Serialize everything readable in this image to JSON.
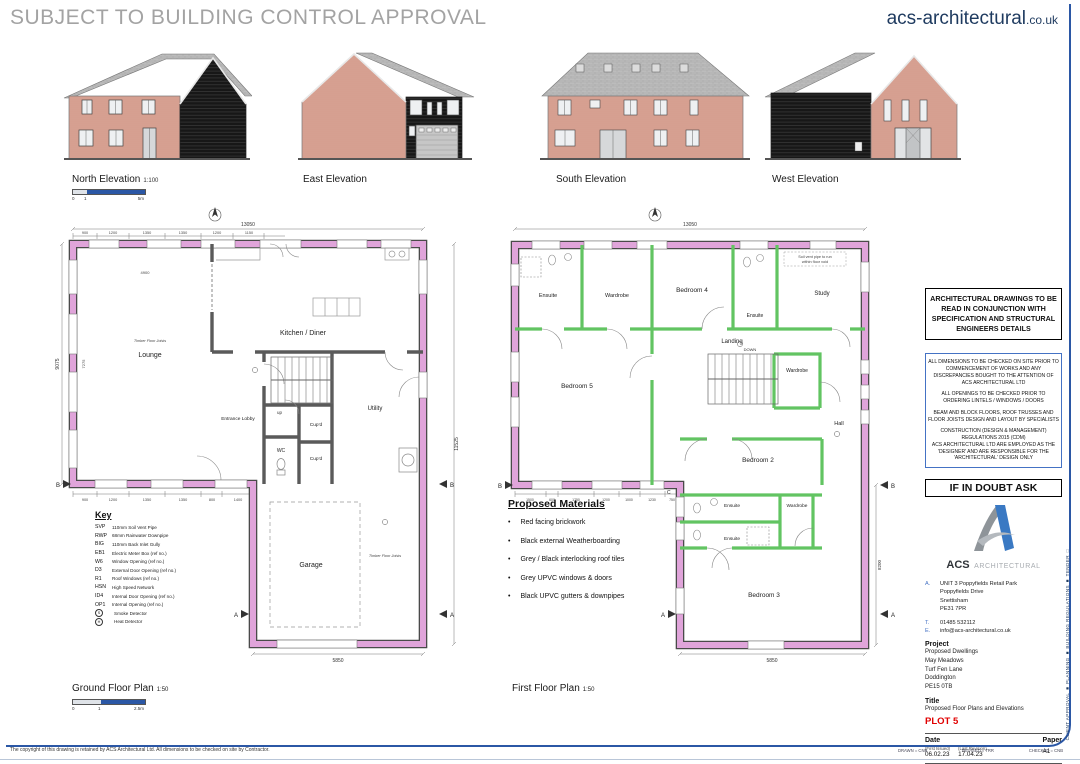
{
  "sheet": {
    "watermark": "SUBJECT TO BUILDING CONTROL APPROVAL",
    "website_name": "acs-architectural",
    "website_tld": ".co.uk"
  },
  "elevations": {
    "north": {
      "label": "North Elevation",
      "scale": "1:100",
      "bar0": "0",
      "bar1": "1",
      "bar2": "5m"
    },
    "east": {
      "label": "East Elevation"
    },
    "south": {
      "label": "South Elevation"
    },
    "west": {
      "label": "West Elevation"
    }
  },
  "ground": {
    "label": "Ground Floor Plan",
    "scale": "1:50",
    "bar0": "0",
    "bar1": "1",
    "bar2": "2.5m",
    "rooms": {
      "lounge": "Lounge",
      "kitchen": "Kitchen / Diner",
      "lobby": "Entrance Lobby",
      "utility": "Utility",
      "wc": "WC",
      "cupd1": "Cup'd",
      "cupd2": "Cup'd",
      "garage": "Garage"
    },
    "stair": "up",
    "timber1": "Timber Floor Joists",
    "timber2": "Timber Floor Joists",
    "dims": {
      "top": "13050",
      "left": "9075",
      "right": "11525",
      "bottom": "5850",
      "inner": "5250",
      "lounge_w": "4900",
      "lounge_h": "7275"
    },
    "top_segs": [
      "900",
      "1200",
      "1350",
      "1350",
      "1200",
      "1150"
    ],
    "bottom_segs": [
      "900",
      "1200",
      "1350",
      "1350",
      "800",
      "1400"
    ]
  },
  "first": {
    "label": "First Floor Plan",
    "scale": "1:50",
    "rooms": {
      "ensuite1": "Ensuite",
      "wardrobe1": "Wardrobe",
      "bed4": "Bedroom 4",
      "ensuite2": "Ensuite",
      "study": "Study",
      "bed5": "Bedroom 5",
      "landing": "Landing",
      "wardrobe2": "Wardrobe",
      "hall": "Hall",
      "bed2": "Bedroom 2",
      "ensuite3": "Ensuite",
      "ensuite4": "Ensuite",
      "wardrobe3": "Wardrobe",
      "bed3": "Bedroom 3"
    },
    "stair": "DOWN",
    "note1": "Soil vent pipe to run",
    "note2": "within floor void",
    "dims": {
      "top": "13050",
      "bottom": "5850",
      "inner": "5250",
      "right": "8200"
    },
    "bottom_segs": [
      "1500",
      "600",
      "1750",
      "1200",
      "1000",
      "1230",
      "750"
    ]
  },
  "markers": {
    "a": "A",
    "b": "B",
    "c": "C"
  },
  "key": {
    "title": "Key",
    "items": [
      {
        "code": "SVP",
        "desc": "110mm Soil Vent Pipe"
      },
      {
        "code": "RWP",
        "desc": "68mm Rainwater Downpipe"
      },
      {
        "code": "BIG",
        "desc": "110mm Back Inlet Gully"
      },
      {
        "code": "EB1",
        "desc": "Electric Meter Box (ref no.)"
      },
      {
        "code": "W6",
        "desc": "Window Opening (ref no.)"
      },
      {
        "code": "D3",
        "desc": "External Door Opening (ref no.)"
      },
      {
        "code": "R1",
        "desc": "Roof Windows (ref no.)"
      },
      {
        "code": "HSN",
        "desc": "High Speed Network"
      },
      {
        "code": "ID4",
        "desc": "Internal Door Opening (ref no.)"
      },
      {
        "code": "OP1",
        "desc": "Internal Opening (ref no.)"
      },
      {
        "code": "S",
        "desc": "Smoke Detector"
      },
      {
        "code": "H",
        "desc": "Heat Detector"
      }
    ]
  },
  "materials": {
    "title": "Proposed Materials",
    "items": [
      "Red facing brickwork",
      "Black external Weatherboarding",
      "Grey / Black interlocking roof tiles",
      "Grey UPVC windows & doors",
      "Black UPVC gutters & downpipes"
    ]
  },
  "notes": {
    "box1": "ARCHITECTURAL DRAWINGS TO BE READ IN CONJUNCTION WITH SPECIFICATION AND STRUCTURAL ENGINEERS DETAILS",
    "box2a": "ALL DIMENSIONS TO BE CHECKED ON SITE PRIOR TO COMMENCEMENT OF WORKS AND ANY DISCREPANCIES BOUGHT TO THE ATTENTION OF ACS ARCHITECTURAL LTD",
    "box2b": "ALL OPENINGS TO BE CHECKED PRIOR TO ORDERING LINTELS / WINDOWS / DOORS",
    "box2c": "BEAM AND BLOCK FLOORS, ROOF TRUSSES AND FLOOR JOISTS  DESIGN AND LAYOUT BY SPECIALISTS",
    "box2d": "CONSTRUCTION (DESIGN & MANAGEMENT) REGULATIONS 2015 (CDM)",
    "box2e": "ACS ARCHITECTURAL LTD ARE EMPLOYED AS THE 'DESIGNER' AND ARE RESPONSIBLE FOR THE 'ARCHITECTURAL' DESIGN ONLY"
  },
  "titleblock": {
    "doubt": "IF IN DOUBT ASK",
    "brand_acs": "ACS",
    "brand_arch": "ARCHITECTURAL",
    "addr_label": "A.",
    "addr1": "UNIT 3 Poppyfields Retail Park",
    "addr2": "Poppyfields Drive",
    "addr3": "Snettisham",
    "addr4": "PE31 7PR",
    "tel_label": "T.",
    "tel": "01485 532112",
    "email_label": "E.",
    "email": "info@acs-architectural.co.uk",
    "project_label": "Project",
    "proj1": "Proposed Dwellings",
    "proj2": "May Meadows",
    "proj3": "Turf Fen Lane",
    "proj4": "Doddington",
    "proj5": "PE15 0TB",
    "title_label": "Title",
    "title": "Proposed Floor Plans and Elevations",
    "plot": "PLOT 5",
    "date_label": "Date",
    "first_issued": "(First Issued)",
    "last_revision": "(Last Revision)",
    "date1": "06.02.23",
    "date2": "17.04.23",
    "paper_label": "Paper",
    "paper": "A1",
    "drawing_label": "Drawing No.",
    "rev_label": "Rev.",
    "drawing_no": "640/20/102 A"
  },
  "footer": {
    "copyright": "The copyright of this drawing is retained by ACS Architectural Ltd. All dimensions to be checked on site by Contractor.",
    "drawn": "DRAWN = CNB",
    "revised": "REVISED = TRR",
    "checked": "CHECKED = CNB",
    "status": "CLIENT APPROVAL ■   PLANNING ■   BUILDING REGULATIONS ■   TENDER □"
  }
}
